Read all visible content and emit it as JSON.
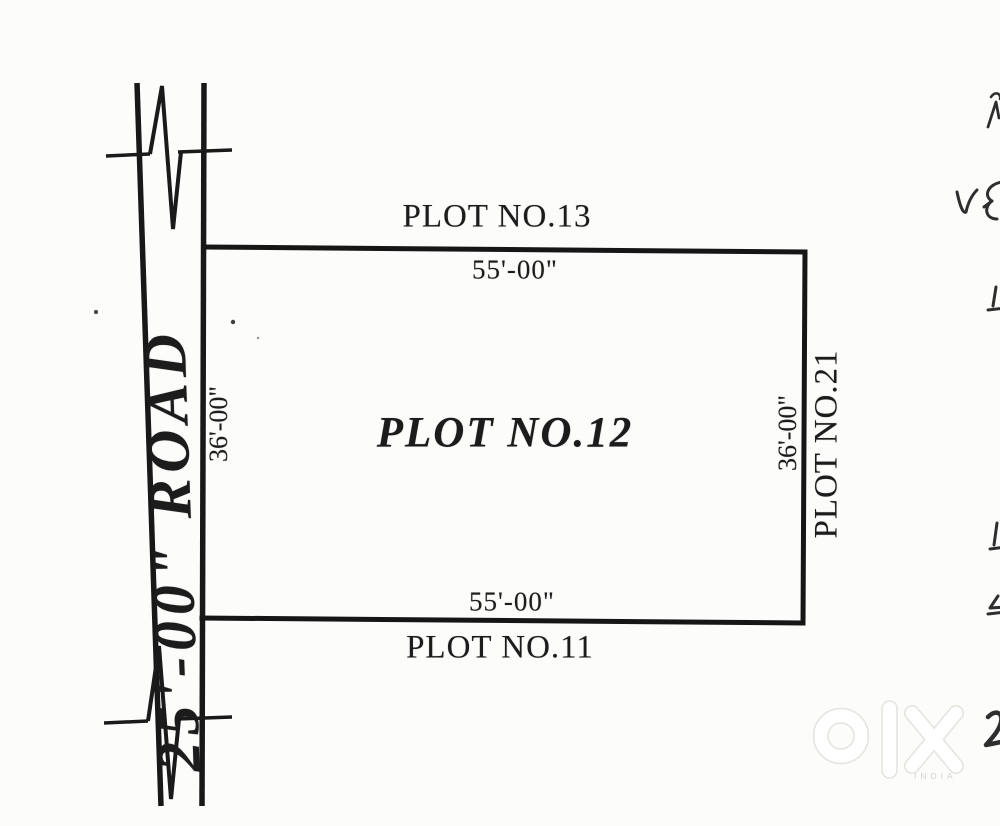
{
  "page": {
    "description": "Scanned hand-drafted site plan of a residential land plot",
    "background": "#fcfcfb",
    "ink": "#1c1c1c"
  },
  "diagram": {
    "road": {
      "label": "25'-00\" ROAD"
    },
    "plot_center": {
      "label": "PLOT NO.12"
    },
    "plot_north": {
      "label": "PLOT NO.13"
    },
    "plot_south": {
      "label": "PLOT NO.11"
    },
    "plot_east": {
      "label": "PLOT NO.21"
    },
    "dimensions": {
      "north": "55'-00\"",
      "south": "55'-00\"",
      "west": "36'-00\"",
      "east": "36'-00\""
    }
  },
  "watermark": {
    "brand": "olx",
    "country_label": "INDIA",
    "outline_color": "#e7e4e0"
  },
  "edge_marks": {
    "note": "partial handwritten annotations clipped at right edge of scan",
    "glyphs": [
      "~",
      "V",
      "&",
      "1",
      "1",
      "4",
      "2"
    ]
  }
}
